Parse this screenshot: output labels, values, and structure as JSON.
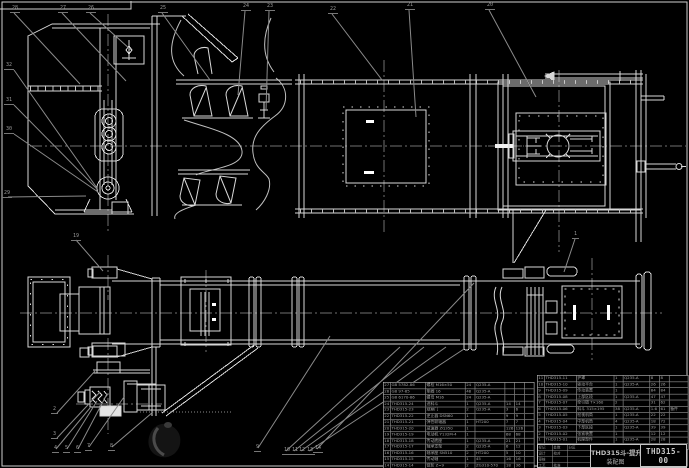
{
  "sheet": {
    "background": "#000000",
    "line_color": "#d8d8d8",
    "leader_color": "#8a8a8a",
    "table_text_color": "#a6a6a6"
  },
  "title_block": {
    "product_title": "THD315斗-提升",
    "product_subtitle": "装配图",
    "drawing_number": "THD315-00",
    "sheet_note": "共1张 第1张",
    "revision_grid": [
      [
        "标记",
        "处数",
        "分区"
      ],
      [
        "设计",
        "校对",
        ""
      ],
      [
        "审核",
        "",
        ""
      ],
      [
        "工艺",
        "批准",
        ""
      ]
    ]
  },
  "bom_right": {
    "headers": [
      "序号",
      "代号",
      "名称",
      "数量",
      "材料",
      "单件",
      "总计",
      "备注"
    ],
    "rows": [
      [
        "11",
        "THD315-11",
        "护罩",
        "1",
        "Q235-A",
        "8",
        "8",
        ""
      ],
      [
        "10",
        "THD315-10",
        "驱动平台",
        "1",
        "Q235-A",
        "26",
        "26",
        ""
      ],
      [
        "9",
        "THD315-09",
        "传动装置",
        "1",
        "",
        "84",
        "84",
        ""
      ],
      [
        "8",
        "THD315-08",
        "上部区段",
        "1",
        "Q235-A",
        "47",
        "47",
        ""
      ],
      [
        "7",
        "THD315-07",
        "牵引链 T×160",
        "2",
        "",
        "31",
        "62",
        ""
      ],
      [
        "6",
        "THD315-06",
        "料斗 315×195",
        "38",
        "Q235-A",
        "1.6",
        "61",
        "备件"
      ],
      [
        "5",
        "THD315-05",
        "检视机筒",
        "1",
        "Q235-A",
        "22",
        "22",
        ""
      ],
      [
        "4",
        "THD315-04",
        "中部机筒",
        "4",
        "Q235-A",
        "18",
        "72",
        ""
      ],
      [
        "3",
        "THD315-03",
        "下部区段",
        "1",
        "Q235-A",
        "39",
        "39",
        ""
      ],
      [
        "2",
        "THD315-02",
        "张紧装置",
        "1",
        "",
        "12",
        "12",
        ""
      ],
      [
        "1",
        "THD315-01",
        "机座部件",
        "1",
        "Q235-A",
        "28",
        "28",
        ""
      ]
    ]
  },
  "bom_left": {
    "rows": [
      [
        "27",
        "GB 5782-86",
        "螺栓 M16×50",
        "24",
        "Q235-A",
        "",
        "",
        ""
      ],
      [
        "26",
        "GB 97-85",
        "垫圈 16",
        "48",
        "Q235-A",
        "",
        "",
        ""
      ],
      [
        "25",
        "GB 6170-86",
        "螺母 M16",
        "24",
        "Q235-A",
        "",
        "",
        ""
      ],
      [
        "24",
        "THD315-24",
        "进料斗",
        "1",
        "Q235-A",
        "14",
        "14",
        ""
      ],
      [
        "23",
        "THD315-23",
        "观察门",
        "2",
        "Q235-A",
        "3",
        "6",
        ""
      ],
      [
        "22",
        "THD315-22",
        "逆止器 DSN60",
        "1",
        "",
        "9",
        "9",
        ""
      ],
      [
        "21",
        "THD315-21",
        "弹性联轴器",
        "1",
        "HT200",
        "7",
        "7",
        ""
      ],
      [
        "20",
        "THD315-20",
        "减速器 ZQ350",
        "1",
        "",
        "126",
        "126",
        ""
      ],
      [
        "19",
        "THD315-19",
        "电动机 Y132M-4",
        "1",
        "",
        "68",
        "68",
        ""
      ],
      [
        "18",
        "THD315-18",
        "传动底座",
        "1",
        "Q235-A",
        "21",
        "21",
        ""
      ],
      [
        "17",
        "THD315-17",
        "轴承支架",
        "2",
        "Q235-A",
        "6",
        "12",
        ""
      ],
      [
        "16",
        "THD315-16",
        "轴承座 SN510",
        "2",
        "HT200",
        "5",
        "10",
        ""
      ],
      [
        "15",
        "THD315-15",
        "传动轴",
        "1",
        "45",
        "16",
        "16",
        ""
      ],
      [
        "14",
        "THD315-14",
        "链轮 Z=9",
        "2",
        "ZG310-570",
        "18",
        "36",
        ""
      ],
      [
        "13",
        "THD315-13",
        "改向轮",
        "2",
        "ZG310-570",
        "11",
        "22",
        ""
      ],
      [
        "12",
        "THD315-12",
        "拉紧螺杆",
        "2",
        "45",
        "2",
        "4",
        ""
      ]
    ]
  },
  "callouts": [
    {
      "n": "28",
      "x": 10,
      "y": 6
    },
    {
      "n": "27",
      "x": 58,
      "y": 6
    },
    {
      "n": "26",
      "x": 86,
      "y": 6
    },
    {
      "n": "25",
      "x": 158,
      "y": 6
    },
    {
      "n": "24",
      "x": 241,
      "y": 4
    },
    {
      "n": "23",
      "x": 265,
      "y": 4
    },
    {
      "n": "22",
      "x": 328,
      "y": 7
    },
    {
      "n": "21",
      "x": 405,
      "y": 3
    },
    {
      "n": "20",
      "x": 485,
      "y": 3
    },
    {
      "n": "32",
      "x": 4,
      "y": 63
    },
    {
      "n": "31",
      "x": 4,
      "y": 98
    },
    {
      "n": "30",
      "x": 4,
      "y": 127
    },
    {
      "n": "29",
      "x": 2,
      "y": 191
    },
    {
      "n": "19",
      "x": 71,
      "y": 234
    },
    {
      "n": "1",
      "x": 572,
      "y": 232
    },
    {
      "n": "2",
      "x": 51,
      "y": 407
    },
    {
      "n": "3",
      "x": 51,
      "y": 432
    },
    {
      "n": "4",
      "x": 52,
      "y": 446
    },
    {
      "n": "5",
      "x": 63,
      "y": 446
    },
    {
      "n": "6",
      "x": 74,
      "y": 446
    },
    {
      "n": "7",
      "x": 85,
      "y": 444
    },
    {
      "n": "8",
      "x": 108,
      "y": 444
    },
    {
      "n": "9",
      "x": 254,
      "y": 445
    },
    {
      "n": "10",
      "x": 282,
      "y": 448
    },
    {
      "n": "11",
      "x": 290,
      "y": 448
    },
    {
      "n": "12",
      "x": 297,
      "y": 448
    },
    {
      "n": "13",
      "x": 305,
      "y": 448
    },
    {
      "n": "14",
      "x": 313,
      "y": 446
    }
  ]
}
